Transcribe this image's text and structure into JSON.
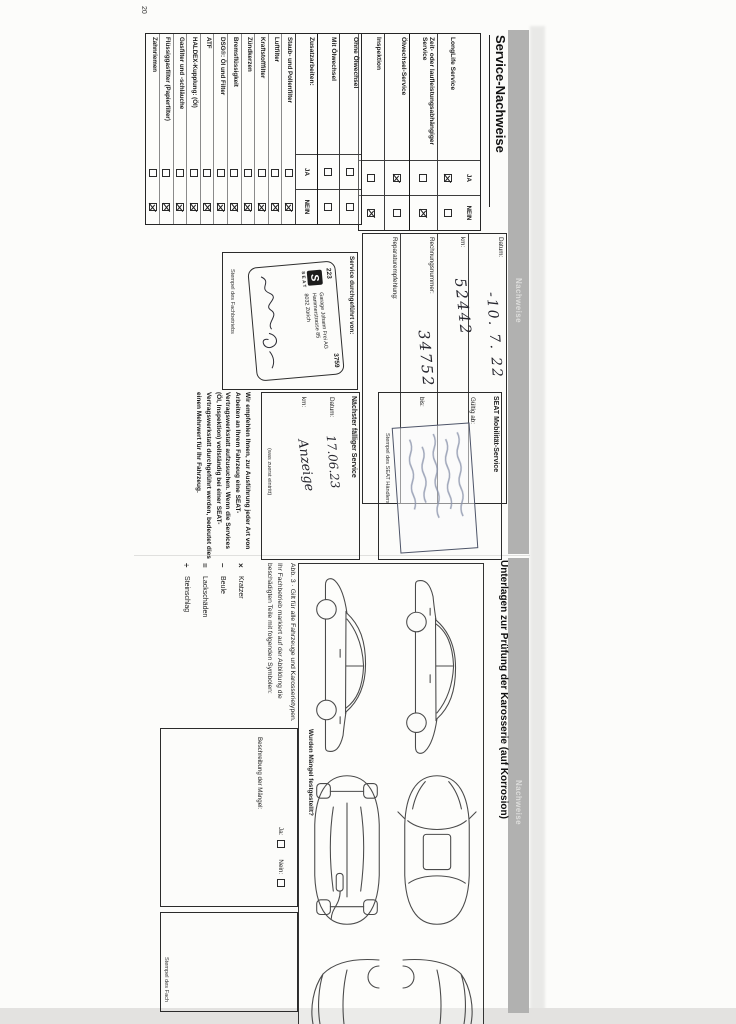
{
  "page_number": "20",
  "tab_label": "Nachweise",
  "left_page": {
    "title": "Service-Nachweise",
    "service_table": {
      "col_ja": "JA",
      "col_nein": "NEIN",
      "rows": [
        {
          "label": "LongLife Service",
          "ja": true,
          "nein": false
        },
        {
          "label": "Zeit- oder laufleistungsabhängiger Ser­vice",
          "ja": false,
          "nein": true
        },
        {
          "label": "Ölwechsel-Service",
          "ja": true,
          "nein": false
        },
        {
          "label": "Inspektion",
          "ja": false,
          "nein": true
        }
      ]
    },
    "details_box": {
      "fields": [
        {
          "label": "Datum:",
          "value": "-10. 7. 22"
        },
        {
          "label": "km:",
          "value": "52442"
        },
        {
          "label": "Rechnungsnummer:",
          "value": "34752"
        },
        {
          "label": "Reparaturempfehlung:",
          "value": ""
        }
      ]
    },
    "extra_table": {
      "col_ja": "JA",
      "col_nein": "NEIN",
      "pre_rows": [
        {
          "label": "Ohne Ölwechsel",
          "ja": false,
          "nein": false
        },
        {
          "label": "Mit Ölwechsel",
          "ja": false,
          "nein": false
        }
      ],
      "header": "Zusatzarbeiten:",
      "rows": [
        {
          "label": "Staub- und Pollenfilter",
          "ja": false,
          "nein": true
        },
        {
          "label": "Luftfilter",
          "ja": false,
          "nein": true
        },
        {
          "label": "Kraftstofffilter",
          "ja": false,
          "nein": true
        },
        {
          "label": "Zündkerzen",
          "ja": false,
          "nein": true
        },
        {
          "label": "Bremsflüssigkeit",
          "ja": false,
          "nein": true
        },
        {
          "label": "DSG®: Öl und Filter",
          "ja": false,
          "nein": true
        },
        {
          "label": "ATF",
          "ja": false,
          "nein": true
        },
        {
          "label": "HALDEX-Kupplung: (Öl)",
          "ja": false,
          "nein": true
        },
        {
          "label": "Gasfilter und -schläuche",
          "ja": false,
          "nein": true
        },
        {
          "label": "Flüssiggasfilter (Papierfilter)",
          "ja": false,
          "nein": true
        },
        {
          "label": "Zahnriemen",
          "ja": false,
          "nein": true
        }
      ]
    },
    "performed_box": {
      "label": "Service durchgeführt von:",
      "stamp": {
        "number_left": "223",
        "number_right": "3759",
        "brand_letter": "S",
        "brand": "SEAT",
        "line1": "Garage Johann Frei AG",
        "line2": "Hammerstrasse 85",
        "line3": "8032 Zürich"
      },
      "footer": "Stempel des Fachbetriebs"
    },
    "mobility_box": {
      "title": "SEAT Mobilität-Service",
      "valid_from": "Gültig ab:",
      "valid_to": "bis:",
      "footer": "Stempel des SEAT Händlers"
    },
    "next_service_box": {
      "title": "Nächster fälliger Service",
      "date_label": "Datum:",
      "date_value": "17.06.23",
      "km_label": "km:",
      "km_value": "Anzeige",
      "note": "(was zuerst eintritt)"
    },
    "recommendation": "Wir empfehlen Ihnen, zur Ausführung jeder Art von Arbeiten an Ihrem Fahrzeug eine SEAT-Vertragswerkstatt aufzusuchen. Wenn die Services (Öl, Inspektion) vollständig bei einer SEAT-Vertragswerkstatt durchgeführt werden, bedeutet dies einen Mehrwert für Ihr Fahrzeug."
  },
  "right_page": {
    "title": "Unterlagen zur Prüfung der Karosserie (auf Korrosion)",
    "caption": "Abb. 3 · Gilt für alle Fahrzeuge und Karosserietypen.",
    "marking_text": "Ihr Fachbetrieb markiert auf der Abbildung die beschädigten Teile mit folgenden Symbolen:",
    "legend": [
      {
        "symbol": "×",
        "label": "Kratzer"
      },
      {
        "symbol": "–",
        "label": "Beule"
      },
      {
        "symbol": "=",
        "label": "Lackschäden"
      },
      {
        "symbol": "÷",
        "label": "Steinschlag"
      }
    ],
    "defects_box": {
      "question": "Wurden Mängel festgestellt?",
      "yes_label": "Ja:",
      "no_label": "Nein:",
      "yes_checked": false,
      "no_checked": false,
      "description_label": "Beschreibung der Mängel:"
    },
    "stamp_box_footer": "Stempel des Fach"
  },
  "colors": {
    "band_gray": "#b1b1b0",
    "paper": "#fcfcfa",
    "ink": "#1b1b1b",
    "stamp_blue": "#8a93ab"
  }
}
